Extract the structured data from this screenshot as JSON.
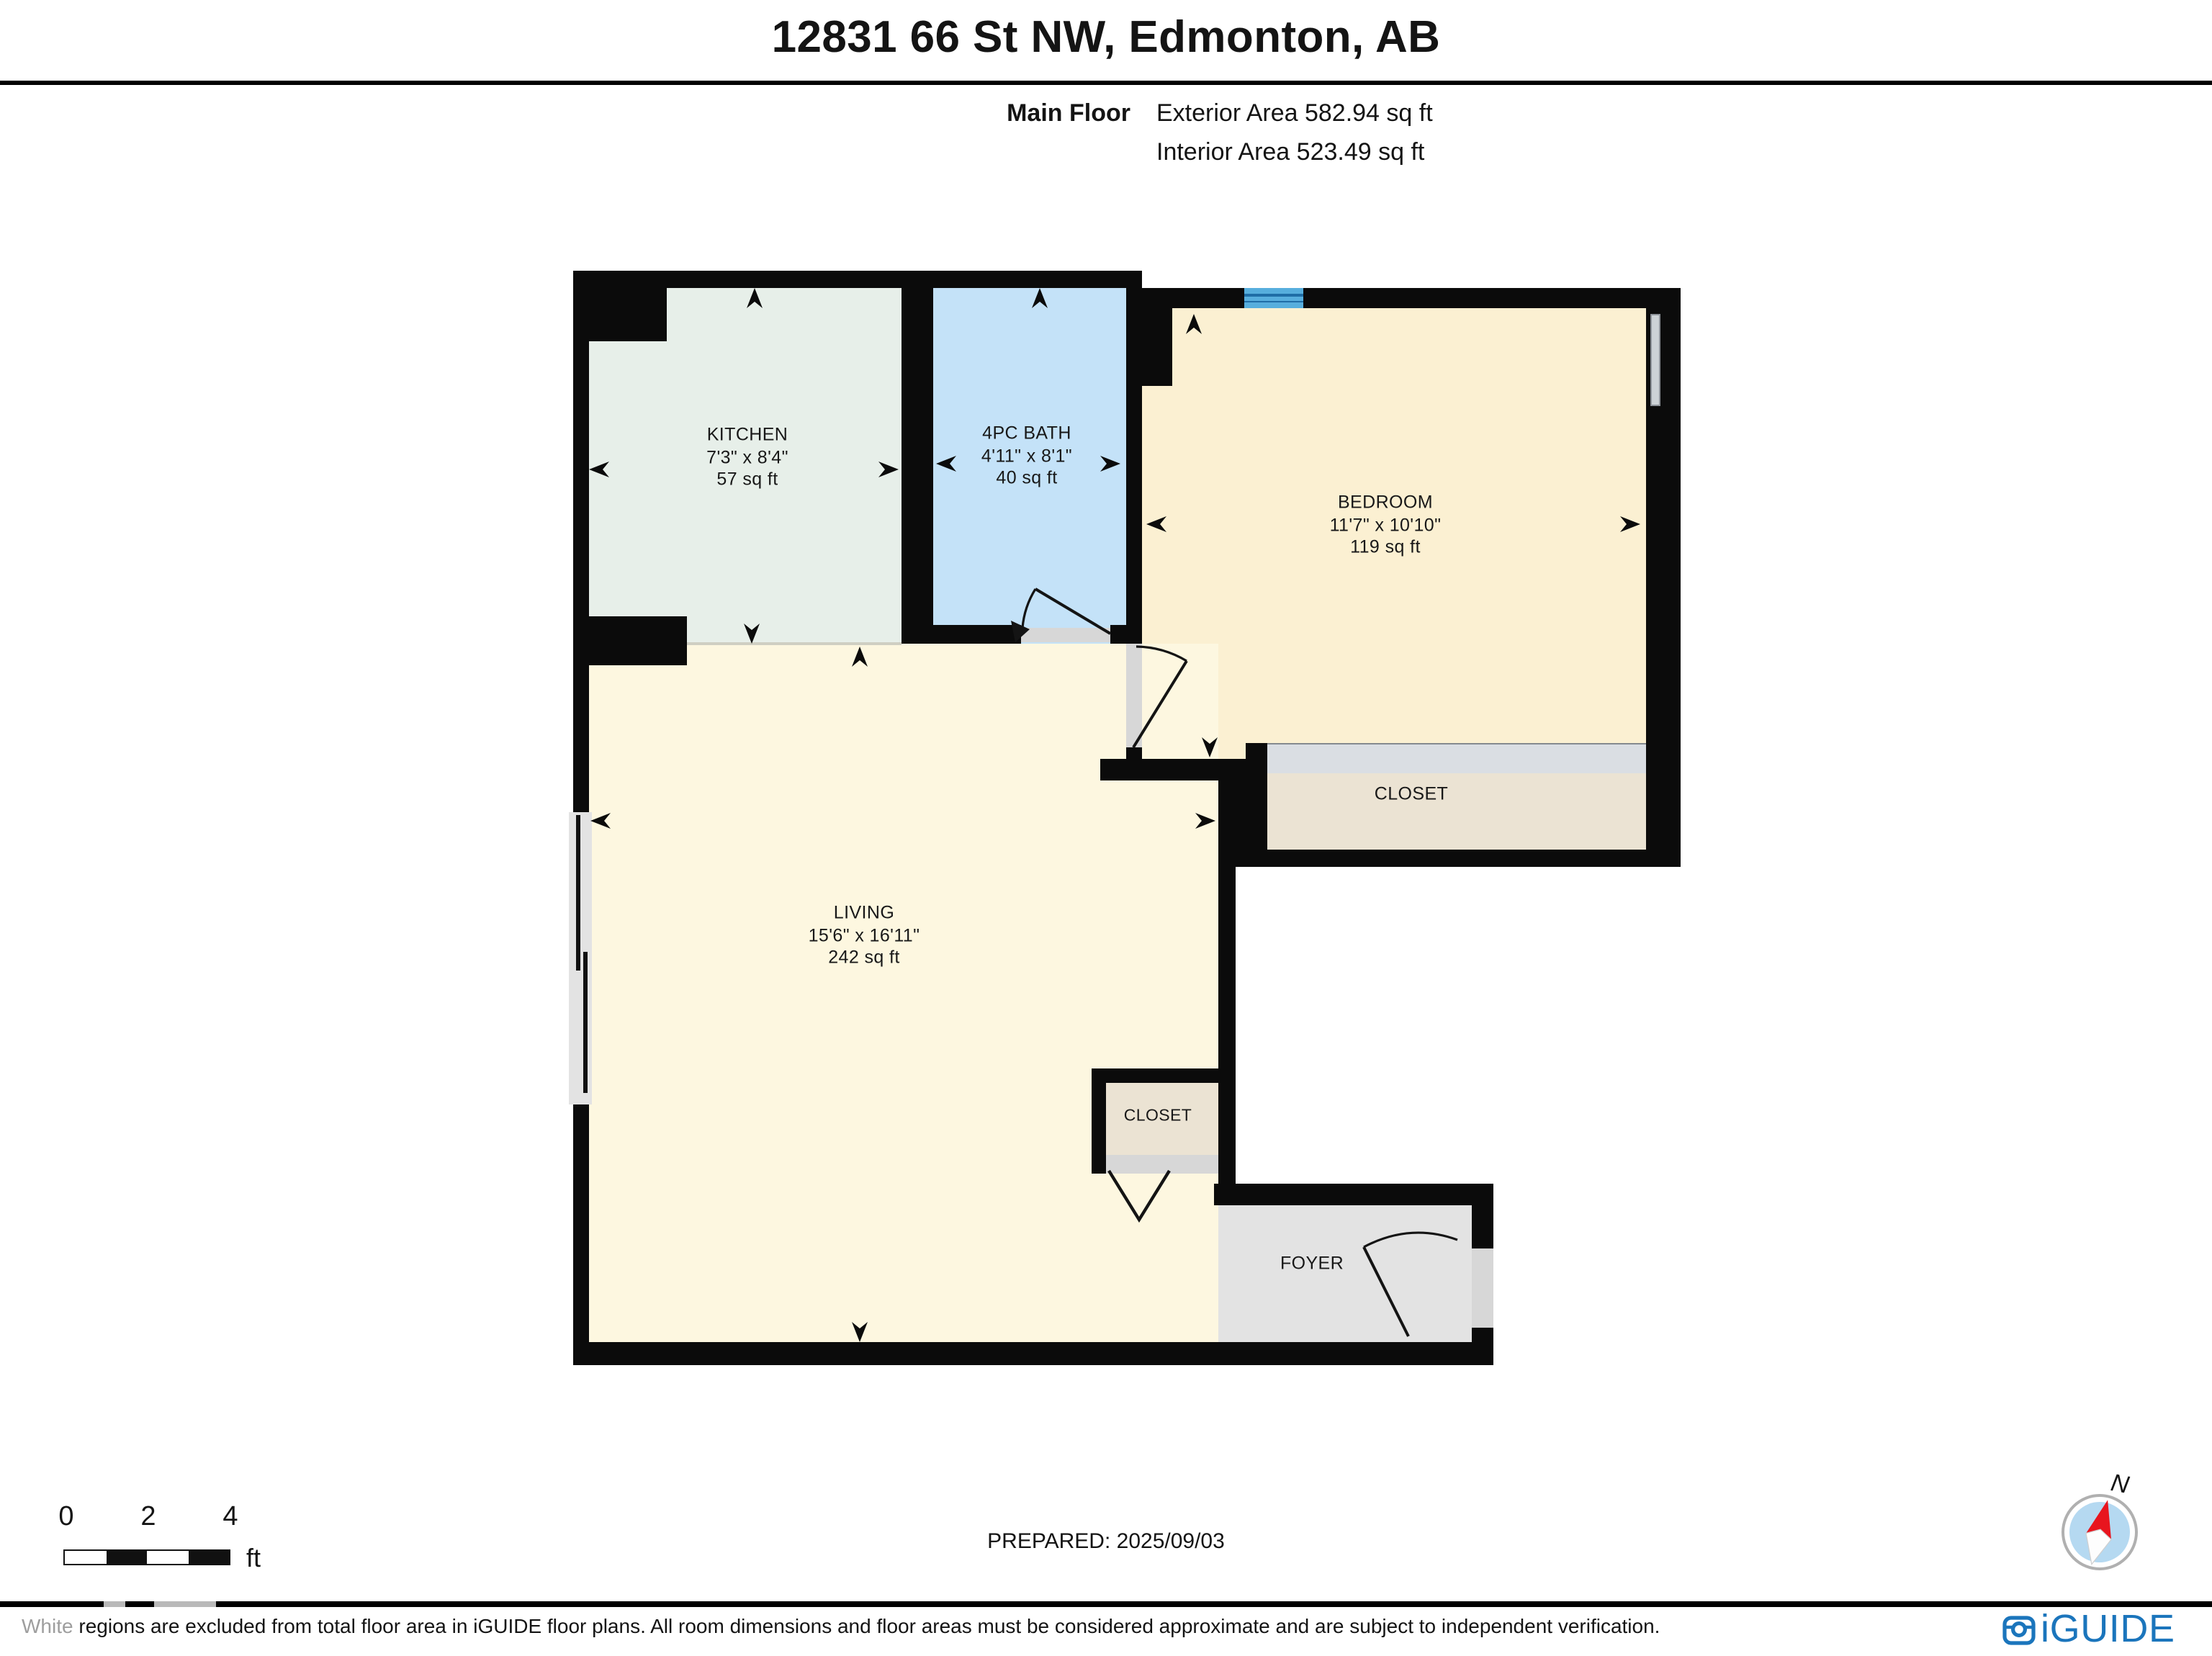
{
  "header": {
    "title": "12831 66 St NW, Edmonton, AB",
    "floor_label": "Main Floor",
    "exterior_area": "Exterior Area 582.94 sq ft",
    "interior_area": "Interior Area 523.49 sq ft"
  },
  "rooms": {
    "kitchen": {
      "name": "KITCHEN",
      "dims": "7'3\" x 8'4\"",
      "area": "57 sq ft"
    },
    "bath": {
      "name": "4PC BATH",
      "dims": "4'11\" x 8'1\"",
      "area": "40 sq ft"
    },
    "bedroom": {
      "name": "BEDROOM",
      "dims": "11'7\" x 10'10\"",
      "area": "119 sq ft"
    },
    "bedroom_closet": {
      "name": "CLOSET"
    },
    "living": {
      "name": "LIVING",
      "dims": "15'6\" x 16'11\"",
      "area": "242 sq ft"
    },
    "living_closet": {
      "name": "CLOSET"
    },
    "foyer": {
      "name": "FOYER"
    }
  },
  "scale_bar": {
    "labels": [
      "0",
      "2",
      "4"
    ],
    "unit": "ft"
  },
  "footer": {
    "prepared": "PREPARED: 2025/09/03",
    "compass_label": "N",
    "disclaimer_lead": "White",
    "disclaimer_rest": " regions are excluded from total floor area in iGUIDE floor plans. All room dimensions and floor areas must be considered approximate and are subject to independent verification.",
    "brand": "iGUIDE"
  },
  "colors": {
    "wall": "#0b0b0b",
    "kitchen_fill": "#e7efe9",
    "bath_fill": "#c4e2f8",
    "bedroom_fill": "#fbf0d2",
    "living_fill": "#fdf7e0",
    "closet_fill": "#ebe3d3",
    "foyer_fill": "#e3e3e3",
    "door_strip": "#d7d7d7",
    "slider_strip": "#dadee3",
    "window_blue": "#57aedd",
    "brand_blue": "#1b75bc",
    "compass_red": "#e8151e",
    "compass_disc": "#b5d9f1"
  }
}
